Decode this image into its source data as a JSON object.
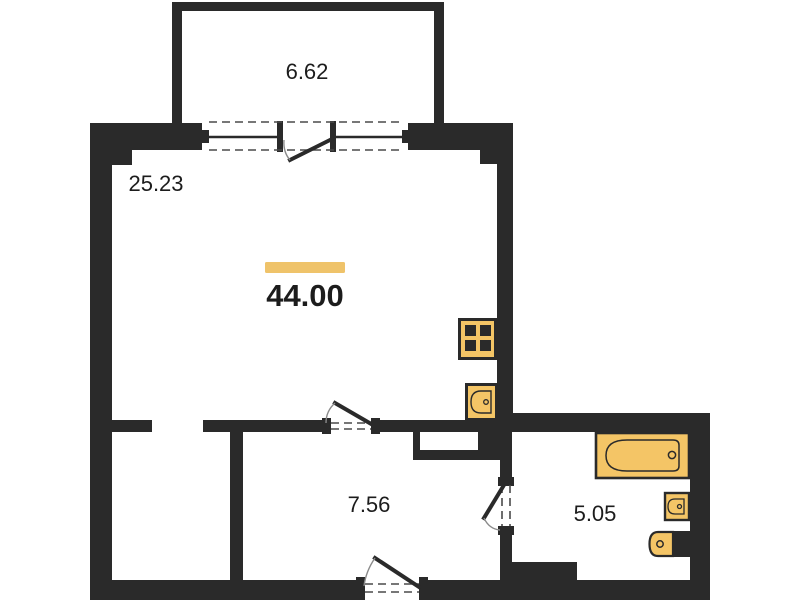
{
  "floor_plan": {
    "type": "apartment floor plan",
    "total_area": "44.00",
    "rooms": [
      {
        "name": "balcony",
        "area": "6.62"
      },
      {
        "name": "living-room",
        "area": "25.23"
      },
      {
        "name": "hallway",
        "area": "7.56"
      },
      {
        "name": "bathroom",
        "area": "5.05"
      }
    ],
    "fixtures": [
      "stove",
      "kitchen-sink",
      "bathtub",
      "washbasin",
      "toilet"
    ],
    "colors": {
      "wall": "#2a2a2a",
      "fixture": "#f4c566",
      "accent_bar": "#efc36a",
      "text": "#1c1c1c",
      "dash": "#4a4a4a",
      "arc": "#8a8a8a",
      "background": "#ffffff"
    }
  }
}
